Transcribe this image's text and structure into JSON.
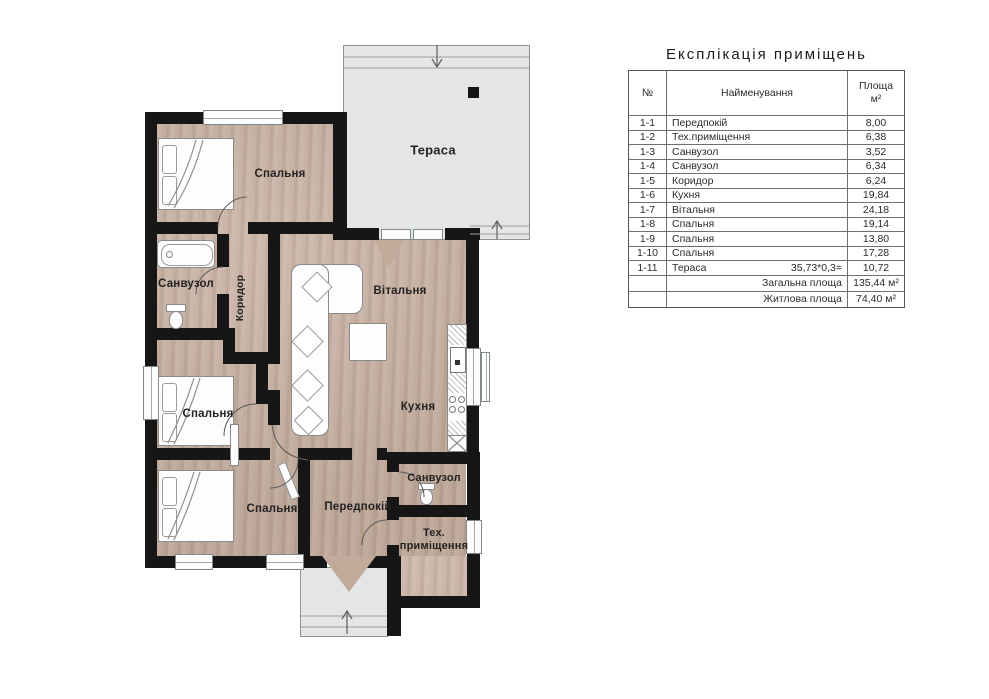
{
  "explication": {
    "title": "Експлікація приміщень",
    "col_headers": {
      "num": "№",
      "name": "Найменування",
      "area_line1": "Площа",
      "area_line2": "м²"
    },
    "rows": [
      {
        "num": "1-1",
        "name": "Передпокій",
        "area": "8,00"
      },
      {
        "num": "1-2",
        "name": "Тех.приміщення",
        "area": "6,38"
      },
      {
        "num": "1-3",
        "name": "Санвузол",
        "area": "3,52"
      },
      {
        "num": "1-4",
        "name": "Санвузол",
        "area": "6,34"
      },
      {
        "num": "1-5",
        "name": "Коридор",
        "area": "6,24"
      },
      {
        "num": "1-6",
        "name": "Кухня",
        "area": "19,84"
      },
      {
        "num": "1-7",
        "name": "Вітальня",
        "area": "24,18"
      },
      {
        "num": "1-8",
        "name": "Спальня",
        "area": "19,14"
      },
      {
        "num": "1-9",
        "name": "Спальня",
        "area": "13,80"
      },
      {
        "num": "1-10",
        "name": "Спальня",
        "area": "17,28"
      },
      {
        "num": "1-11",
        "name": "Тераса",
        "note": "35,73*0,3=",
        "area": "10,72"
      }
    ],
    "summary": [
      {
        "label": "Загальна площа",
        "value": "135,44 м²"
      },
      {
        "label": "Житлова площа",
        "value": "74,40 м²"
      }
    ]
  },
  "plan": {
    "rooms": {
      "terrace": "Тераса",
      "bedroom_top": "Спальня",
      "bathroom_main": "Санвузол",
      "corridor": "Коридор",
      "living_room": "Вітальня",
      "kitchen": "Кухня",
      "bedroom_middle": "Спальня",
      "bedroom_bottom": "Спальня",
      "hallway": "Передпокій",
      "bathroom_small": "Санвузол",
      "tech_room_line1": "Тех.",
      "tech_room_line2": "приміщення"
    }
  },
  "colors": {
    "wall": "#161616",
    "floor": "#c7b0a1",
    "terrace": "#e4e6e5"
  }
}
